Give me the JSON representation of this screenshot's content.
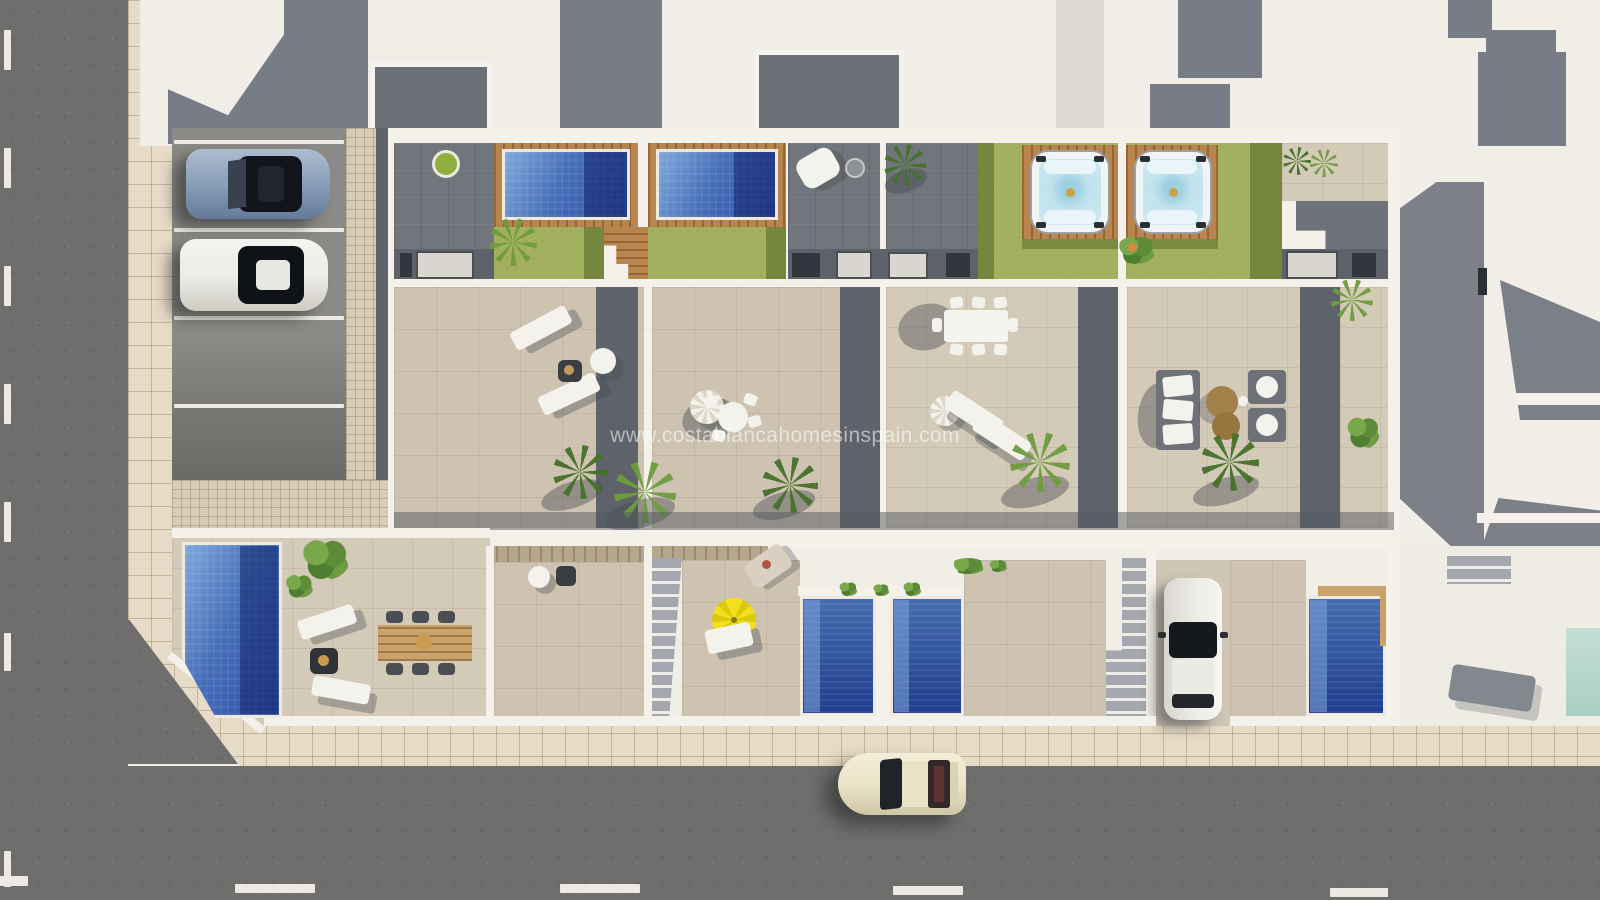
{
  "watermark": {
    "text": "www.costablancahomesinspain.com"
  },
  "palette": {
    "asphalt": "#6f6e6c",
    "pavement": "#e6dbc6",
    "roof_white": "#f1eee7",
    "wall_white": "#f4f1ea",
    "roof_gray": "#787c86",
    "solarium_gray": "#71757c",
    "terrace_beige": "#cec3b1",
    "shadow_gray": "#5e626a",
    "lawn_green": "#a3b05f",
    "lawn_shadow": "#75863f",
    "wood_deck": "#b9854e",
    "pool_blue": "#4870ba",
    "pool_deep": "#1f3d8d",
    "jacuzzi_water": "#bfe2ec",
    "parasol_yellow": "#f2e01e",
    "car_blue": "#8ba0ba",
    "car_white": "#edece7",
    "car_cream": "#ebe3c6",
    "pouf_brown": "#a28049"
  },
  "scene": {
    "description": "Aerial 3D render of four new-build townhouses with roof solariums (two tiled pools, two jacuzzis on wood decks), a corner villa garden with private pool and dining set, ground-floor patios with plunge pools and stairs, street parking with two cars, a driveway car and a cream classic car driving on the street.",
    "cars": [
      {
        "label": "blue sports car parked in street parking"
      },
      {
        "label": "white car parked in street parking"
      },
      {
        "label": "white car parked in driveway"
      },
      {
        "label": "cream classic car driving on street"
      }
    ],
    "water_features": [
      {
        "label": "rooftop pool villa 1"
      },
      {
        "label": "rooftop pool villa 2"
      },
      {
        "label": "jacuzzi villa 3"
      },
      {
        "label": "jacuzzi villa 4"
      },
      {
        "label": "garden pool corner villa"
      },
      {
        "label": "patio plunge pool villa 2"
      },
      {
        "label": "patio plunge pool villa 3"
      },
      {
        "label": "patio plunge pool villa 4"
      },
      {
        "label": "neighbour pool at frame edge"
      }
    ]
  }
}
